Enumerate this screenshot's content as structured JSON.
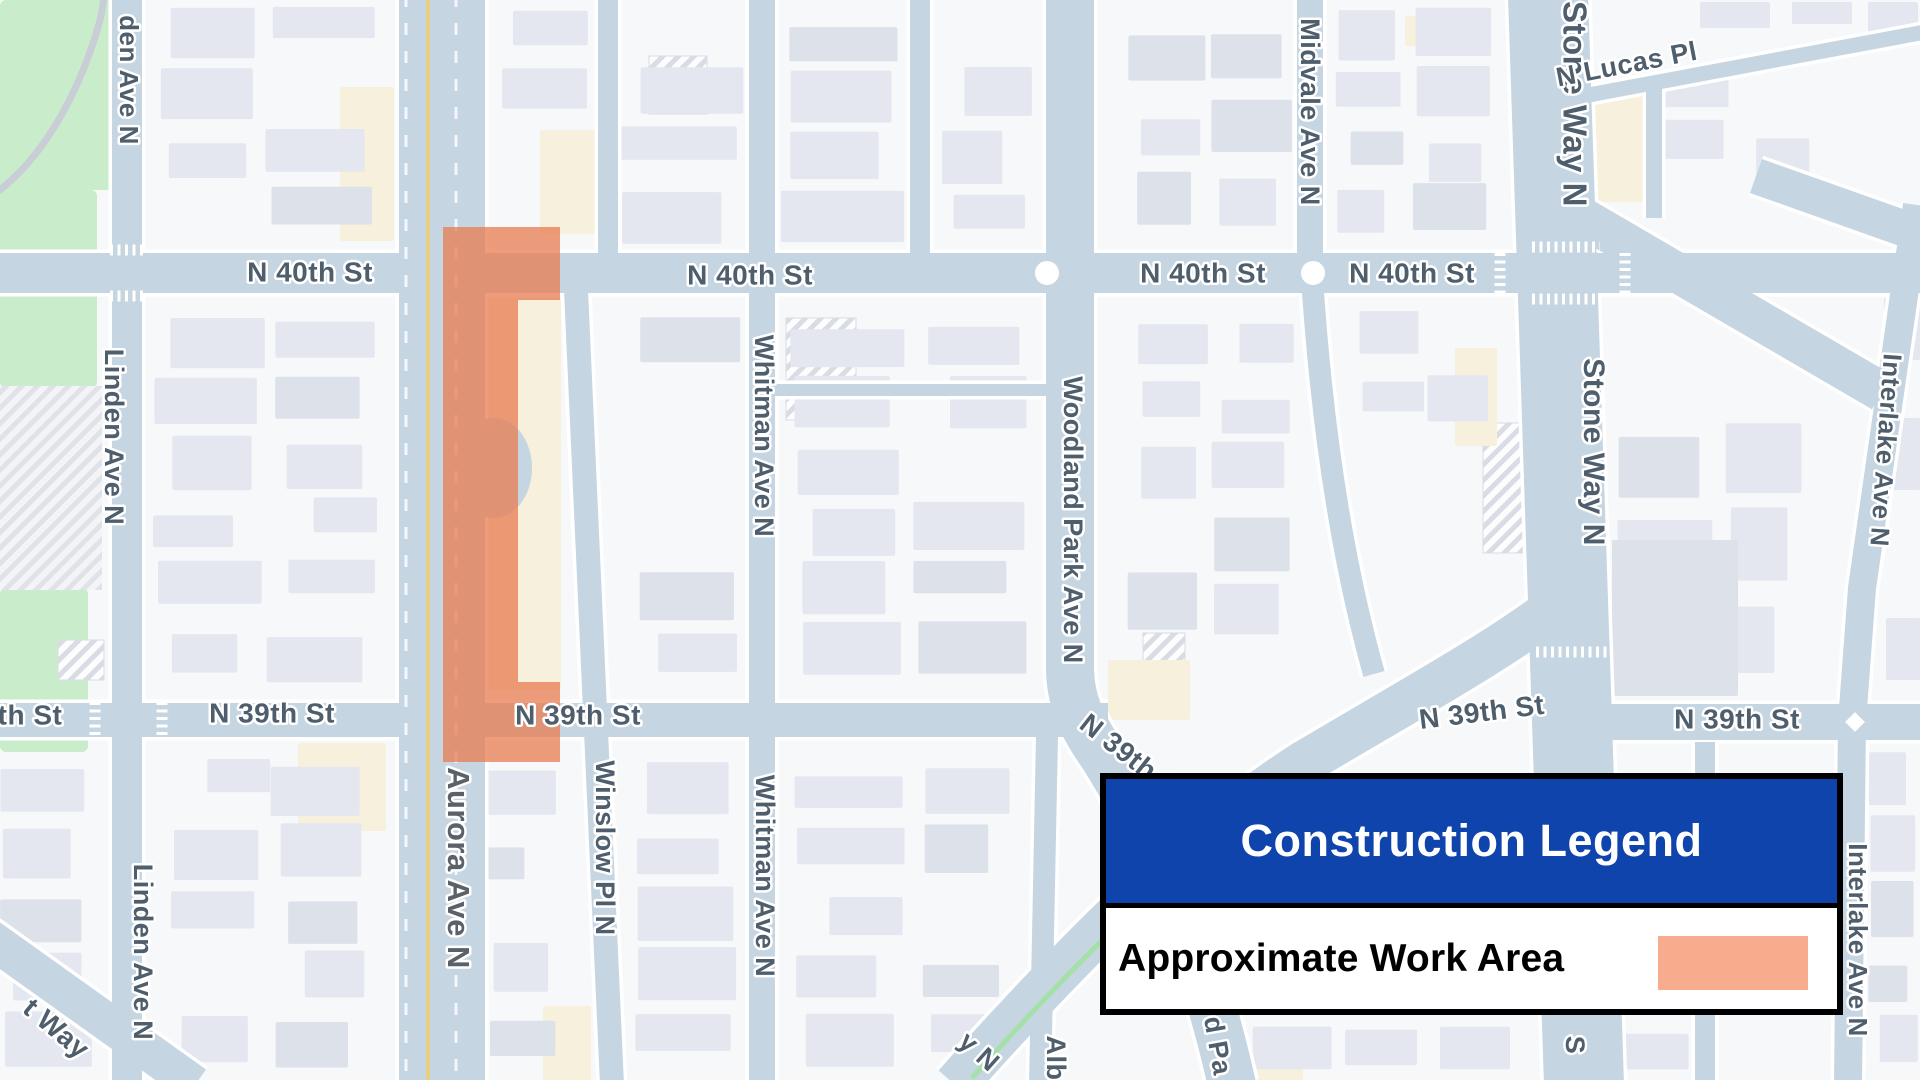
{
  "legend": {
    "title": "Construction Legend",
    "item_label": "Approximate Work Area",
    "colors": {
      "header_bg": "#0f44ad",
      "header_text": "#ffffff",
      "row_bg": "#ffffff",
      "row_text": "#000000",
      "swatch": "#f6ac8d",
      "border": "#000000"
    }
  },
  "map": {
    "colors": {
      "background": "#f7f8fa",
      "street": "#c6d5e2",
      "casing": "#ffffff",
      "building": "#e4e7ef",
      "building_dark": "#dde1ea",
      "building_cream": "#f7f0dd",
      "park": "#c9edcb",
      "park_gray": "#e8eaee",
      "park_path": "#c9cdd5",
      "hatch_bg": "#fdfdfe",
      "hatch_line": "#d8dce5",
      "label": "#4f5e6c",
      "highway_label": "#5a6168",
      "work_area": "#e87d52",
      "yellow_line": "#eccd6e",
      "green_line": "#a5e0a8"
    },
    "work_area_opacity": 0.76,
    "labels": [
      {
        "t": "den Ave N",
        "x": 127,
        "y": 80,
        "r": 90,
        "s": 26
      },
      {
        "t": "Linden Ave N",
        "x": 112,
        "y": 437,
        "r": 90,
        "s": 27
      },
      {
        "t": "Linden Ave N",
        "x": 141,
        "y": 952,
        "r": 90,
        "s": 27
      },
      {
        "t": "N 40th St",
        "x": 310,
        "y": 274,
        "r": 0,
        "s": 28
      },
      {
        "t": "N 40th St",
        "x": 750,
        "y": 277,
        "r": 0,
        "s": 28
      },
      {
        "t": "N 40th St",
        "x": 1203,
        "y": 275,
        "r": 0,
        "s": 28
      },
      {
        "t": "N 40th St",
        "x": 1412,
        "y": 275,
        "r": 0,
        "s": 28
      },
      {
        "t": "Midvale Ave N",
        "x": 1308,
        "y": 112,
        "r": 90,
        "s": 27
      },
      {
        "t": "Stone Way N",
        "x": 1572,
        "y": 104,
        "r": 90,
        "s": 33
      },
      {
        "t": "N Lucas Pl",
        "x": 1627,
        "y": 66,
        "r": -11,
        "s": 27
      },
      {
        "t": "Whitman Ave N",
        "x": 762,
        "y": 436,
        "r": 90,
        "s": 27
      },
      {
        "t": "Woodland Park Ave N",
        "x": 1071,
        "y": 520,
        "r": 90,
        "s": 27
      },
      {
        "t": "Stone Way N",
        "x": 1592,
        "y": 452,
        "r": 90,
        "s": 30
      },
      {
        "t": "Interlake Ave N",
        "x": 1884,
        "y": 450,
        "r": 94,
        "s": 26
      },
      {
        "t": "th St",
        "x": 30,
        "y": 717,
        "r": 0,
        "s": 28
      },
      {
        "t": "N 39th St",
        "x": 272,
        "y": 715,
        "r": 0,
        "s": 28
      },
      {
        "t": "N 39th St",
        "x": 578,
        "y": 717,
        "r": 0,
        "s": 28
      },
      {
        "t": "N 39th St",
        "x": 1132,
        "y": 760,
        "r": 38,
        "s": 28
      },
      {
        "t": "N 39th St",
        "x": 1482,
        "y": 714,
        "r": -7,
        "s": 28
      },
      {
        "t": "N 39th St",
        "x": 1737,
        "y": 721,
        "r": 0,
        "s": 28
      },
      {
        "t": "Aurora Ave N",
        "x": 456,
        "y": 868,
        "r": 90,
        "s": 31,
        "c": "#5a6168"
      },
      {
        "t": "Winslow Pl N",
        "x": 603,
        "y": 848,
        "r": 90,
        "s": 27
      },
      {
        "t": "Whitman Ave N",
        "x": 763,
        "y": 876,
        "r": 90,
        "s": 27
      },
      {
        "t": "t Way",
        "x": 55,
        "y": 1030,
        "r": 40,
        "s": 28
      },
      {
        "t": "y N",
        "x": 978,
        "y": 1053,
        "r": 42,
        "s": 27
      },
      {
        "t": "Alb",
        "x": 1054,
        "y": 1058,
        "r": 90,
        "s": 27
      },
      {
        "t": "d Pa",
        "x": 1216,
        "y": 1046,
        "r": 80,
        "s": 27
      },
      {
        "t": "S",
        "x": 1573,
        "y": 1045,
        "r": 90,
        "s": 27
      },
      {
        "t": "Interlake Ave N",
        "x": 1856,
        "y": 940,
        "r": 90,
        "s": 26
      }
    ]
  }
}
